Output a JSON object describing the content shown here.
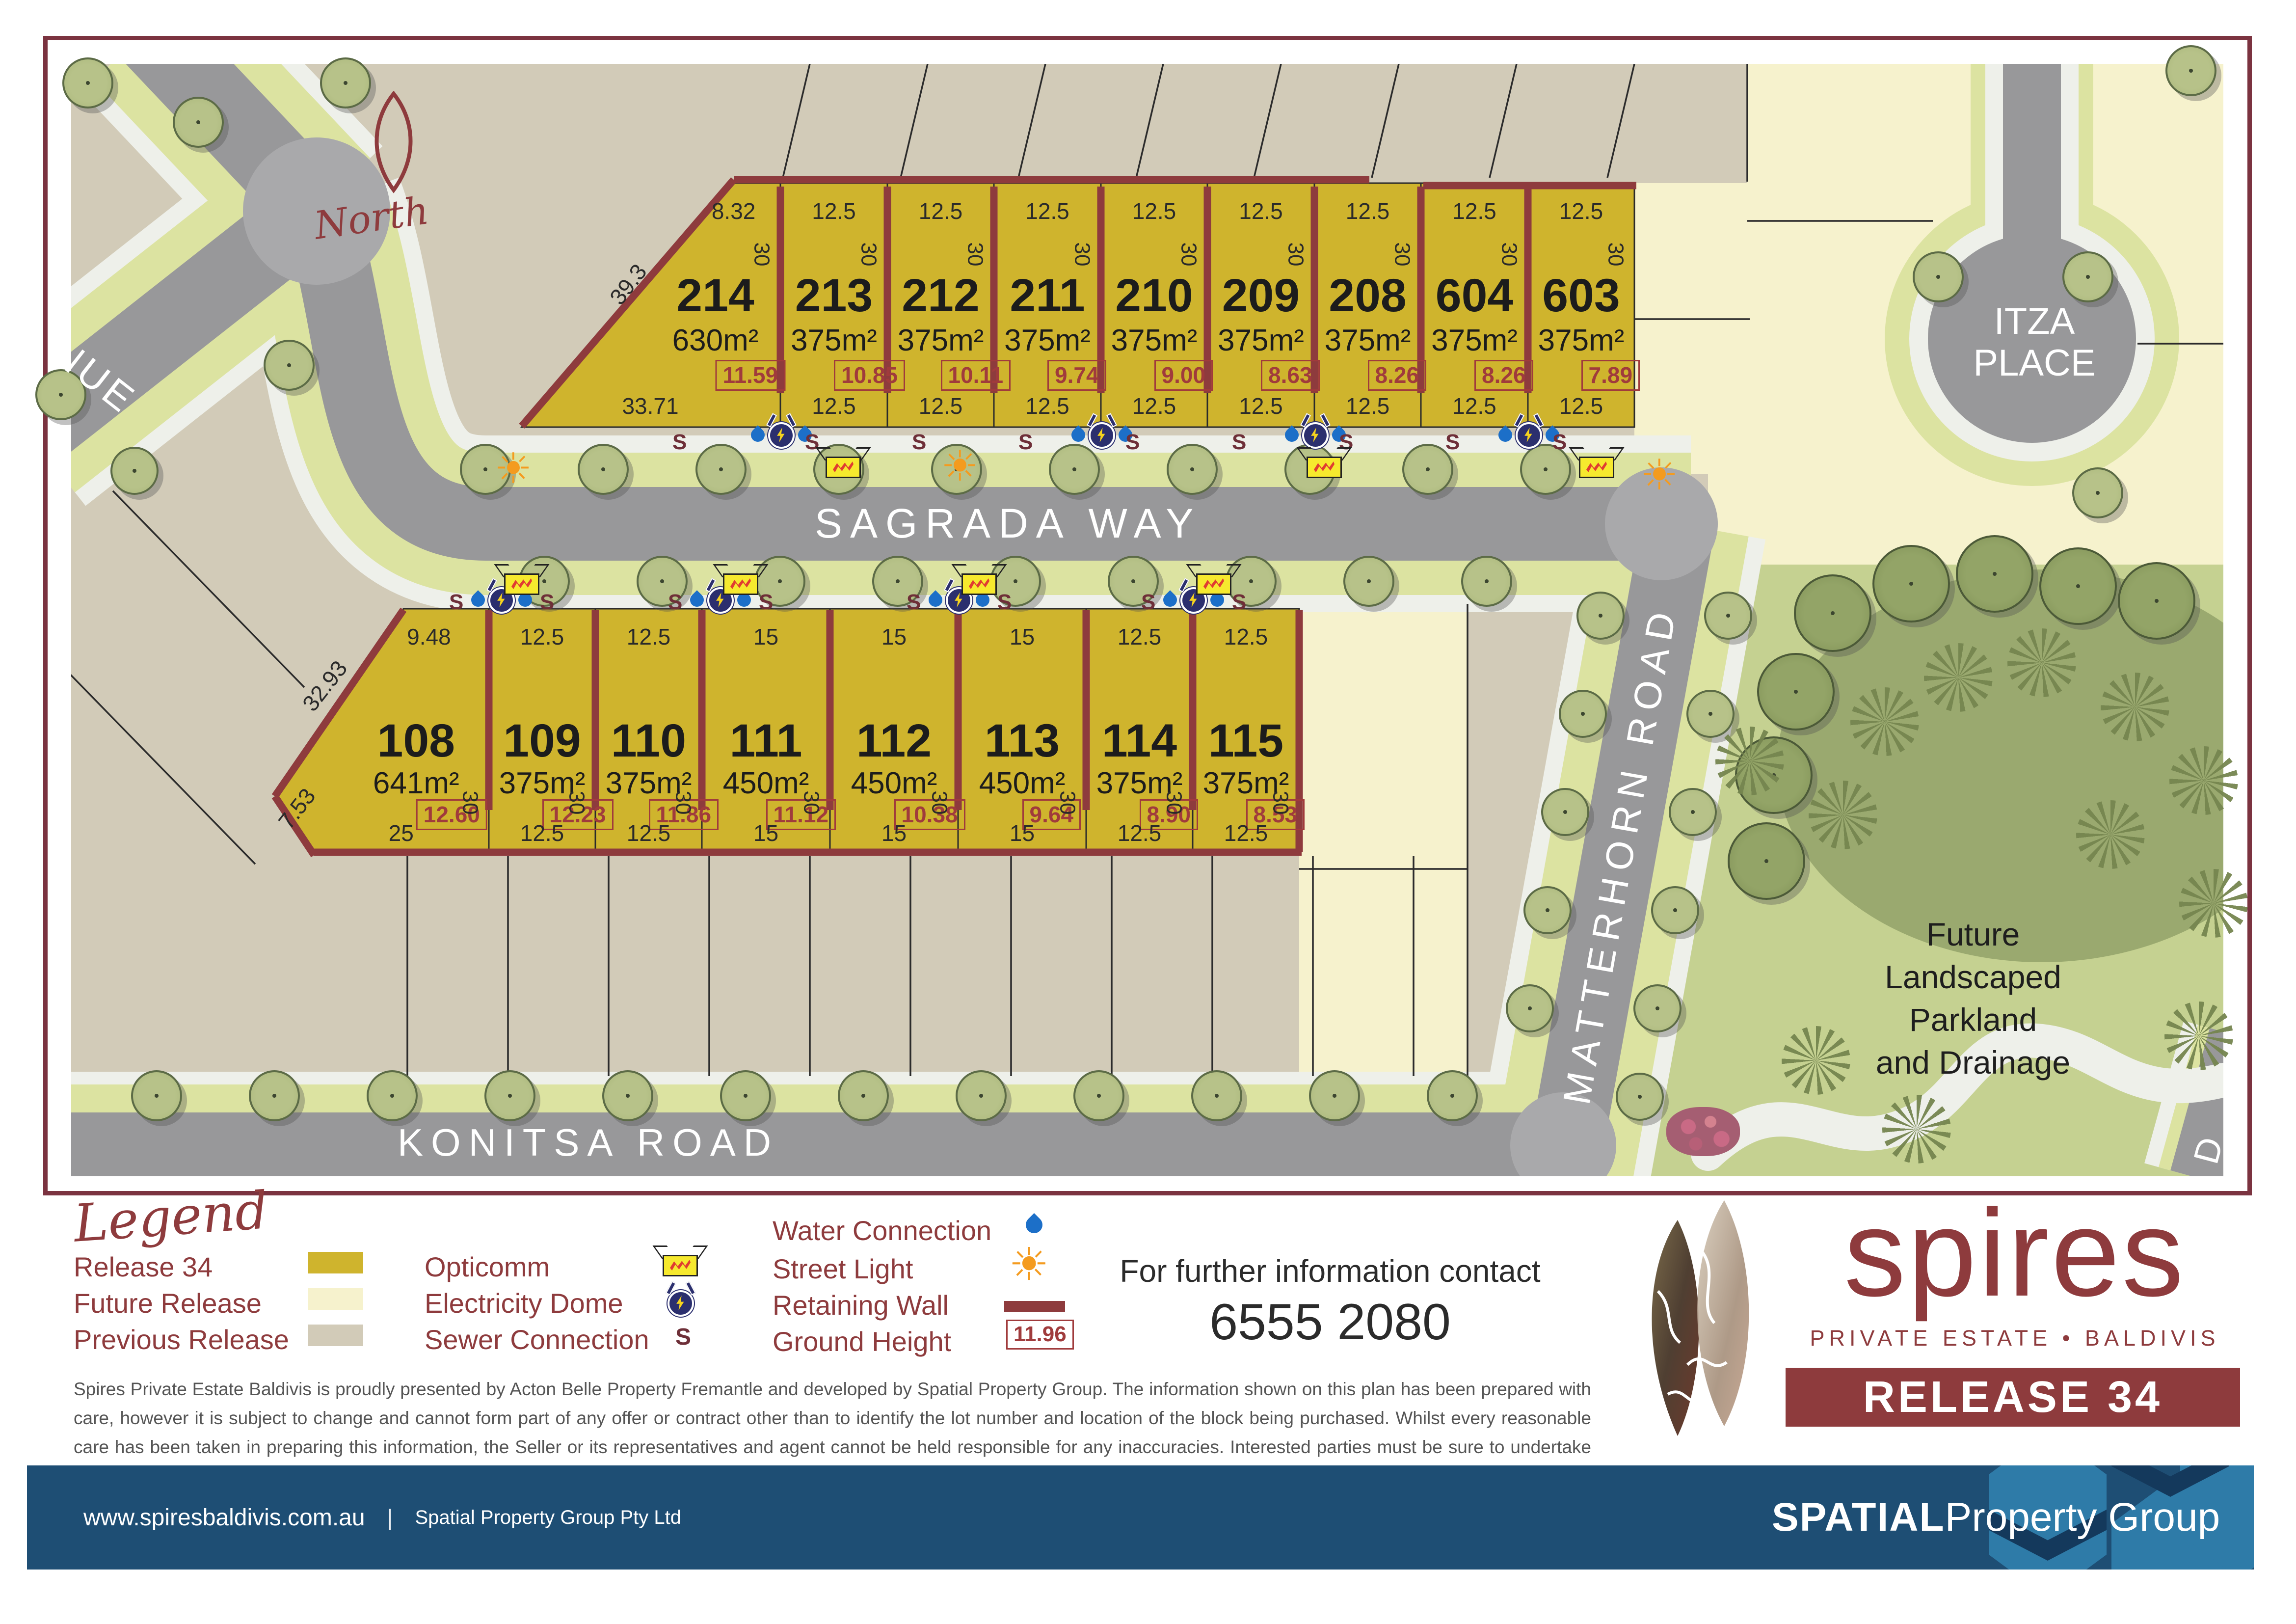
{
  "map": {
    "north_label": "North",
    "roads": {
      "sagrada": "SAGRADA  WAY",
      "konitsa": "KONITSA  ROAD",
      "matterhorn": "MATTERHORN   ROAD",
      "itza": [
        "ITZA",
        "PLACE"
      ],
      "avenue_fragment": "NUE",
      "edge_fragment": "D"
    },
    "parkland_label": [
      "Future",
      "Landscaped",
      "Parkland",
      "and Drainage"
    ],
    "lots_top": [
      {
        "number": "214",
        "area": "630m²",
        "ground_height": "11.59",
        "front": "8.32",
        "rear": "33.71",
        "depth": "30",
        "side": "39.3"
      },
      {
        "number": "213",
        "area": "375m²",
        "ground_height": "10.85",
        "front": "12.5",
        "rear": "12.5",
        "depth": "30"
      },
      {
        "number": "212",
        "area": "375m²",
        "ground_height": "10.11",
        "front": "12.5",
        "rear": "12.5",
        "depth": "30"
      },
      {
        "number": "211",
        "area": "375m²",
        "ground_height": "9.74",
        "front": "12.5",
        "rear": "12.5",
        "depth": "30"
      },
      {
        "number": "210",
        "area": "375m²",
        "ground_height": "9.00",
        "front": "12.5",
        "rear": "12.5",
        "depth": "30"
      },
      {
        "number": "209",
        "area": "375m²",
        "ground_height": "8.63",
        "front": "12.5",
        "rear": "12.5",
        "depth": "30"
      },
      {
        "number": "208",
        "area": "375m²",
        "ground_height": "8.26",
        "front": "12.5",
        "rear": "12.5",
        "depth": "30"
      },
      {
        "number": "604",
        "area": "375m²",
        "ground_height": "8.26",
        "front": "12.5",
        "rear": "12.5",
        "depth": "30"
      },
      {
        "number": "603",
        "area": "375m²",
        "ground_height": "7.89",
        "front": "12.5",
        "rear": "12.5",
        "depth": "30"
      }
    ],
    "lots_bottom": [
      {
        "number": "108",
        "area": "641m²",
        "ground_height": "12.60",
        "front": "9.48",
        "rear": "25",
        "depth": "30",
        "side": "32.93",
        "side2": "7.53"
      },
      {
        "number": "109",
        "area": "375m²",
        "ground_height": "12.23",
        "front": "12.5",
        "rear": "12.5",
        "depth": "30"
      },
      {
        "number": "110",
        "area": "375m²",
        "ground_height": "11.86",
        "front": "12.5",
        "rear": "12.5",
        "depth": "30"
      },
      {
        "number": "111",
        "area": "450m²",
        "ground_height": "11.12",
        "front": "15",
        "rear": "15",
        "depth": "30"
      },
      {
        "number": "112",
        "area": "450m²",
        "ground_height": "10.38",
        "front": "15",
        "rear": "15",
        "depth": "30"
      },
      {
        "number": "113",
        "area": "450m²",
        "ground_height": "9.64",
        "front": "15",
        "rear": "15",
        "depth": "30"
      },
      {
        "number": "114",
        "area": "375m²",
        "ground_height": "8.90",
        "front": "12.5",
        "rear": "12.5",
        "depth": "30"
      },
      {
        "number": "115",
        "area": "375m²",
        "ground_height": "8.53",
        "front": "12.5",
        "rear": "12.5",
        "depth": "30"
      }
    ]
  },
  "legend": {
    "title": "Legend",
    "releases": [
      {
        "label": "Release 34",
        "color": "#cfb42d"
      },
      {
        "label": "Future Release",
        "color": "#f6f2cd"
      },
      {
        "label": "Previous Release",
        "color": "#d2cbb8"
      }
    ],
    "utilities": [
      {
        "label": "Opticomm",
        "icon": "opticomm-icon"
      },
      {
        "label": "Electricity Dome",
        "icon": "electricity-dome-icon"
      },
      {
        "label": "Sewer Connection",
        "icon": "sewer-icon"
      }
    ],
    "services": [
      {
        "label": "Water Connection",
        "icon": "water-drop-icon"
      },
      {
        "label": "Street Light",
        "icon": "street-light-icon"
      },
      {
        "label": "Retaining Wall",
        "icon": "retaining-wall-icon"
      },
      {
        "label": "Ground Height",
        "icon": "ground-height-icon",
        "sample": "11.96"
      }
    ],
    "sewer_glyph": "S"
  },
  "icons": {
    "street_light": "☀",
    "sewer": "S"
  },
  "contact": {
    "line1": "For further information contact",
    "phone": "6555 2080"
  },
  "disclaimer": "Spires Private Estate Baldivis is proudly presented by Acton Belle Property Fremantle and developed by Spatial Property Group. The information shown on this plan has been prepared with care, however it is subject to change and cannot form part of any offer or contract other than to identify the lot number and location of the block being purchased. Whilst every reasonable care has been taken in preparing this information, the Seller or its representatives and agent cannot be held responsible for any inaccuracies. Interested parties must be sure to undertake their own independent enquiries. Lot information is subject to survey and Titles Office approval. Prices are subject to change without notice.",
  "brand": {
    "name": "spires",
    "tagline": "PRIVATE ESTATE  •  BALDIVIS",
    "release_badge": "RELEASE 34",
    "accent": "#8e3b3d"
  },
  "footer": {
    "website": "www.spiresbaldivis.com.au",
    "separator": "|",
    "company": "Spatial Property Group Pty Ltd",
    "logo_bold": "SPATIAL",
    "logo_rest": " Property Group"
  },
  "colors": {
    "release34": "#cfb42d",
    "future": "#f6f2cd",
    "previous": "#d2cbb8",
    "road": "#98989a",
    "verge": "#dce3a1",
    "parkland": "#c5d191",
    "maroon": "#8e3b3d",
    "footer_blue": "#1e4e74"
  }
}
